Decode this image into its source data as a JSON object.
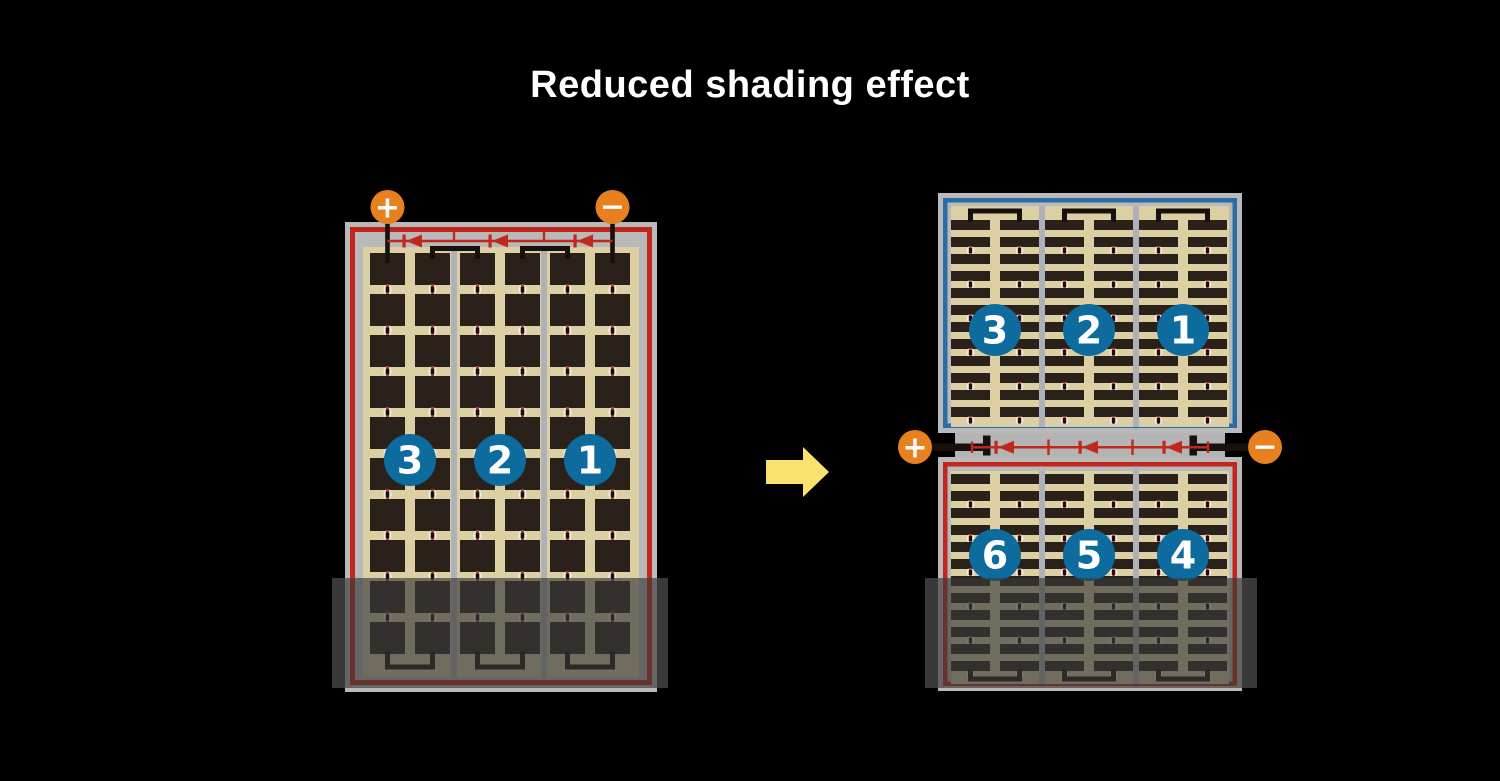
{
  "title": {
    "text": "Reduced shading effect"
  },
  "colors": {
    "background": "#000000",
    "title_text": "#ffffff",
    "terminal_orange": "#e8801f",
    "string_badge_blue": "#0e6b9e",
    "cell_dark": "#2b211b",
    "cell_field_tan": "#dbcfa3",
    "frame_gray": "#b9b9b9",
    "separator_gray": "#aeb2b8",
    "border_red": "#c1271d",
    "border_blue": "#2a6da4",
    "diode_red": "#c0281e",
    "wire_black": "#17100d",
    "arrow_yellow": "#f9e36e"
  },
  "left_module": {
    "description": "full-cell module, partially shaded at bottom",
    "terminals": {
      "positive": "+",
      "negative": "−"
    },
    "cell_strings": [
      "3",
      "2",
      "1"
    ],
    "bypass_diode_count": 3,
    "shaded": true
  },
  "right_module": {
    "description": "split half-cell module, partially shaded at bottom",
    "terminals": {
      "positive": "+",
      "negative": "−"
    },
    "upper_cell_strings": [
      "3",
      "2",
      "1"
    ],
    "lower_cell_strings": [
      "6",
      "5",
      "4"
    ],
    "bypass_diode_count": 3,
    "shaded": true
  }
}
